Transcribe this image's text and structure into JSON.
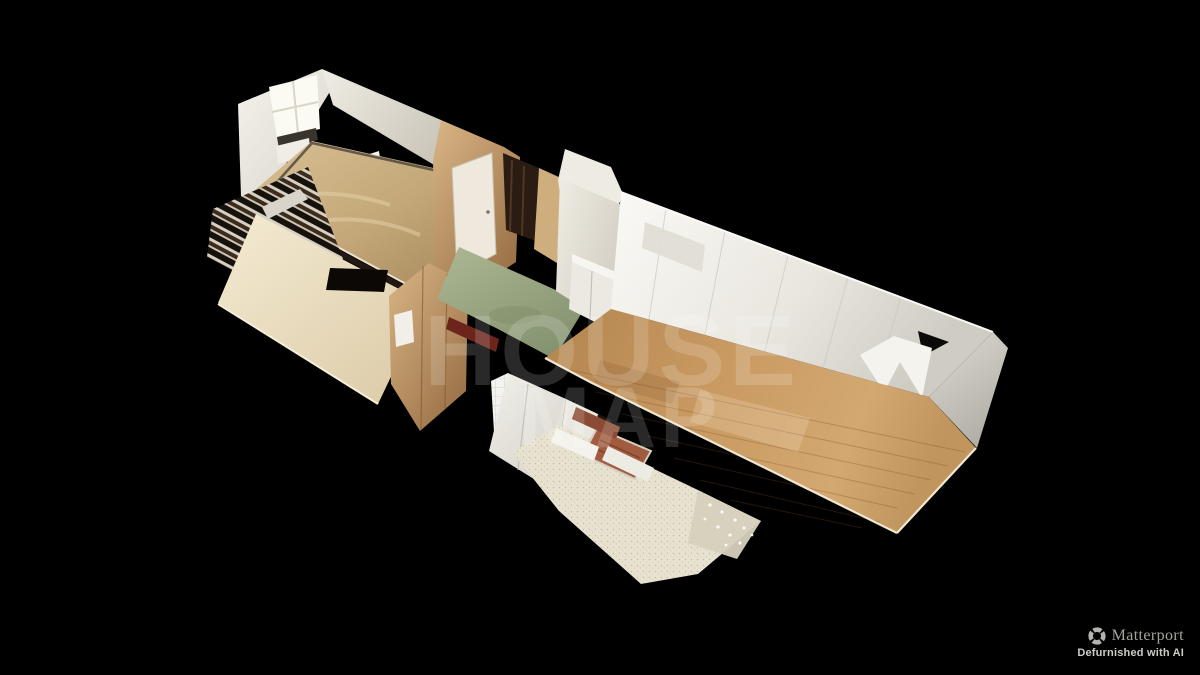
{
  "view": {
    "mode_name": "dollhouse-3d-view",
    "description_names": [
      "apartment-scan",
      "cutaway-floorplan"
    ]
  },
  "watermark": {
    "line1": "HOUSE",
    "line2": "MAP",
    "color": "#ffffff"
  },
  "branding": {
    "logo_icon": "matterport-shutter-icon",
    "logo_text": "Matterport",
    "tagline": "Defurnished with AI"
  },
  "colors": {
    "background": "#000000",
    "wordmark": "#a6a4a1",
    "icon": "#b5b3b0",
    "tagline": "#cdcbc8",
    "watermark": "#ffffff",
    "carpet": "#c7ab7e",
    "birch_floor": "#ead9b8",
    "oak_floor": "#c6965e",
    "green_floor": "#9aa882",
    "plywood": "#cba36a",
    "wall_white": "#f2f1ec",
    "bath_floor": "#e7e1d0",
    "genkan_tile": "#a15c40",
    "maroon_beam": "#6c251b"
  },
  "regions": [
    "bedroom-back-room",
    "balcony-louvers",
    "wood-floor-room",
    "entry-hall-green-floor",
    "living-room",
    "washroom-bathroom",
    "genkan-tile-mat"
  ]
}
